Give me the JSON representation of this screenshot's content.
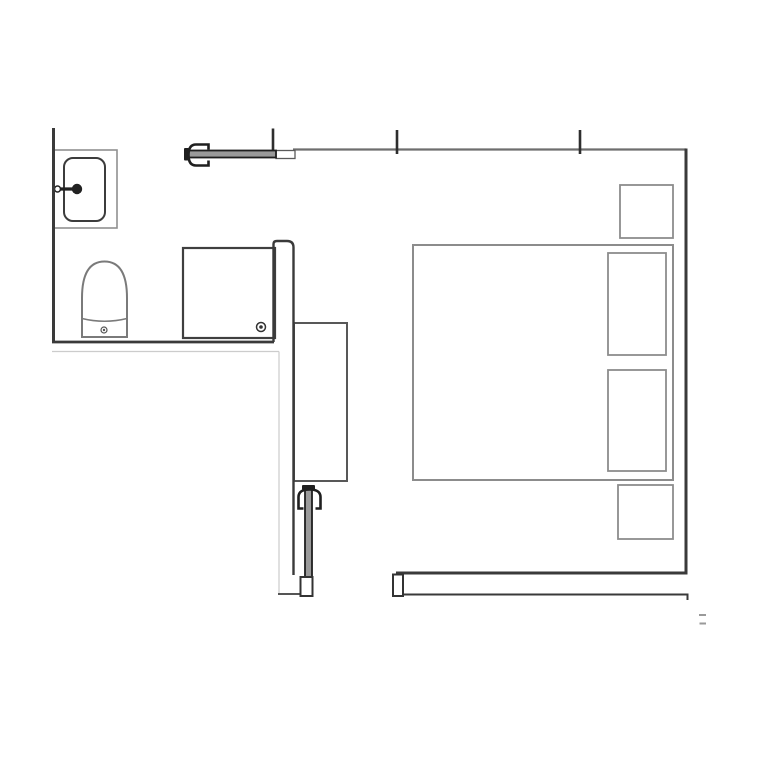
{
  "canvas": {
    "width": 768,
    "height": 768,
    "background": "#ffffff"
  },
  "palette": {
    "wall_dark": "#3a3a3a",
    "wall_medium": "#6e6e6e",
    "fixture_dark": "#3c3c3c",
    "fixture_gray": "#7a7a7a",
    "furniture_gray": "#8c8c8c",
    "door_dark": "#1f1f1f",
    "door_fill": "#9a9a9a",
    "faint_line": "#cccccc"
  },
  "floor_plan": {
    "rooms": [
      {
        "name": "bathroom"
      },
      {
        "name": "bedroom"
      }
    ],
    "shapes": [
      {
        "name": "bathroom-wall-shadow-line",
        "type": "line",
        "x1": 52,
        "y1": 351.5,
        "x2": 279,
        "y2": 351.5,
        "stroke": "#cccccc",
        "sw": 1.2
      },
      {
        "name": "hall-wall-faint-line",
        "type": "line",
        "x1": 279,
        "y1": 351.5,
        "x2": 279,
        "y2": 594,
        "stroke": "#cccccc",
        "sw": 1.2
      },
      {
        "name": "sink-counter",
        "type": "rect",
        "x": 53,
        "y": 150,
        "width": 64,
        "height": 78,
        "stroke": "#909090",
        "sw": 1.6,
        "fill": "#ffffff"
      },
      {
        "name": "sink-basin",
        "type": "rect",
        "x": 64,
        "y": 158,
        "width": 41,
        "height": 63,
        "rx": 9,
        "stroke": "#3c3c3c",
        "sw": 2,
        "fill": "#ffffff"
      },
      {
        "name": "sink-faucet-stem",
        "type": "line",
        "x1": 52,
        "y1": 189,
        "x2": 73,
        "y2": 189,
        "stroke": "#222222",
        "sw": 3.2
      },
      {
        "name": "sink-faucet-handle",
        "type": "circle",
        "cx": 77,
        "cy": 189,
        "r": 5.2,
        "fill": "#222222"
      },
      {
        "name": "sink-faucet-valve",
        "type": "circle",
        "cx": 57.5,
        "cy": 189,
        "r": 3,
        "stroke": "#222222",
        "sw": 1.5,
        "fill": "#ffffff"
      },
      {
        "name": "toilet-body",
        "type": "path",
        "d": "M82 337 L82 298 Q82 261.5 104.5 261.5 Q127 261.5 127 298 L127 337 Z",
        "stroke": "#7a7a7a",
        "sw": 2,
        "fill": "#ffffff"
      },
      {
        "name": "toilet-seat-line",
        "type": "path",
        "d": "M82 318.5 Q104.5 324 127 318.5",
        "stroke": "#7a7a7a",
        "sw": 1.6
      },
      {
        "name": "toilet-bolt",
        "type": "circle",
        "cx": 104,
        "cy": 330,
        "r": 3,
        "stroke": "#555555",
        "sw": 1.2,
        "fill": "#ffffff"
      },
      {
        "name": "toilet-bolt-dot",
        "type": "circle",
        "cx": 104,
        "cy": 330,
        "r": 1.2,
        "fill": "#555555"
      },
      {
        "name": "shower-tray",
        "type": "rect",
        "x": 183,
        "y": 248,
        "width": 92,
        "height": 90,
        "stroke": "#3f3f3f",
        "sw": 2.2,
        "fill": "#ffffff"
      },
      {
        "name": "shower-drain",
        "type": "circle",
        "cx": 261,
        "cy": 327,
        "r": 4.5,
        "stroke": "#333333",
        "sw": 1.5,
        "fill": "#ffffff"
      },
      {
        "name": "shower-drain-dot",
        "type": "circle",
        "cx": 261,
        "cy": 327,
        "r": 1.8,
        "fill": "#333333"
      },
      {
        "name": "wardrobe",
        "type": "rect",
        "x": 294,
        "y": 323,
        "width": 53,
        "height": 158,
        "stroke": "#585858",
        "sw": 2,
        "fill": "#ffffff"
      },
      {
        "name": "bed",
        "type": "rect",
        "x": 413,
        "y": 245,
        "width": 260,
        "height": 235,
        "stroke": "#8c8c8c",
        "sw": 2,
        "fill": "#ffffff"
      },
      {
        "name": "pillow-top",
        "type": "rect",
        "x": 608,
        "y": 253,
        "width": 58,
        "height": 102,
        "stroke": "#8c8c8c",
        "sw": 1.8,
        "fill": "#ffffff"
      },
      {
        "name": "pillow-bottom",
        "type": "rect",
        "x": 608,
        "y": 370,
        "width": 58,
        "height": 101,
        "stroke": "#8c8c8c",
        "sw": 1.8,
        "fill": "#ffffff"
      },
      {
        "name": "nightstand-top",
        "type": "rect",
        "x": 620,
        "y": 185,
        "width": 53,
        "height": 53,
        "stroke": "#8c8c8c",
        "sw": 1.8,
        "fill": "#ffffff"
      },
      {
        "name": "nightstand-bottom",
        "type": "rect",
        "x": 618,
        "y": 485,
        "width": 55,
        "height": 54,
        "stroke": "#8c8c8c",
        "sw": 1.8,
        "fill": "#ffffff"
      },
      {
        "name": "partition-wall",
        "type": "path",
        "d": "M273.5 342 L273.5 244 Q273.5 241 277 241 L287 241 Q293.5 241 293.5 247.5 L293.5 575",
        "stroke": "#3a3a3a",
        "sw": 2.4
      },
      {
        "name": "left-wall",
        "type": "line",
        "x1": 53.5,
        "y1": 128,
        "x2": 53.5,
        "y2": 343,
        "stroke": "#3a3a3a",
        "sw": 3
      },
      {
        "name": "bathroom-bottom-wall",
        "type": "line",
        "x1": 52,
        "y1": 342,
        "x2": 274,
        "y2": 342,
        "stroke": "#3a3a3a",
        "sw": 2.8
      },
      {
        "name": "top-wall",
        "type": "line",
        "x1": 293,
        "y1": 149.5,
        "x2": 686,
        "y2": 149.5,
        "stroke": "#6e6e6e",
        "sw": 2.2
      },
      {
        "name": "top-door-frame-jog",
        "type": "rect",
        "x": 276,
        "y": 150.5,
        "width": 19,
        "height": 8,
        "stroke": "#5a5a5a",
        "sw": 1.3,
        "fill": "#ffffff"
      },
      {
        "name": "wall-tick-left",
        "type": "line",
        "x1": 273,
        "y1": 128.5,
        "x2": 273,
        "y2": 155,
        "stroke": "#2e2e2e",
        "sw": 2.6
      },
      {
        "name": "wall-tick-mid",
        "type": "line",
        "x1": 397,
        "y1": 130,
        "x2": 397,
        "y2": 154,
        "stroke": "#2e2e2e",
        "sw": 2.6
      },
      {
        "name": "wall-tick-right",
        "type": "line",
        "x1": 580,
        "y1": 130,
        "x2": 580,
        "y2": 154,
        "stroke": "#2e2e2e",
        "sw": 2.6
      },
      {
        "name": "right-wall",
        "type": "line",
        "x1": 686,
        "y1": 148.5,
        "x2": 686,
        "y2": 574.5,
        "stroke": "#3a3a3a",
        "sw": 3
      },
      {
        "name": "bottom-wall",
        "type": "line",
        "x1": 396,
        "y1": 573,
        "x2": 687.5,
        "y2": 573,
        "stroke": "#3a3a3a",
        "sw": 3
      },
      {
        "name": "bottom-rail",
        "type": "path",
        "d": "M397 594.5 L687.5 594.5 L687.5 600",
        "stroke": "#3a3a3a",
        "sw": 2
      },
      {
        "name": "bottom-rail-end-cap",
        "type": "rect",
        "x": 393,
        "y": 574.5,
        "width": 10,
        "height": 21.5,
        "stroke": "#333333",
        "sw": 2,
        "fill": "#ffffff"
      },
      {
        "name": "entry-wall-stub",
        "type": "line",
        "x1": 278,
        "y1": 594,
        "x2": 301,
        "y2": 594,
        "stroke": "#555555",
        "sw": 2
      },
      {
        "name": "entry-door-leaf",
        "type": "rect",
        "x": 305,
        "y": 489,
        "width": 7,
        "height": 88,
        "stroke": "#1f1f1f",
        "sw": 1.8,
        "fill": "#9a9a9a"
      },
      {
        "name": "entry-door-pivot",
        "type": "rect",
        "x": 302,
        "y": 485,
        "width": 13,
        "height": 5,
        "rx": 1,
        "fill": "#1f1f1f"
      },
      {
        "name": "entry-door-hinge",
        "type": "path",
        "d": "M303.5 508.5 L298.5 508.5 L298.5 497 Q298.5 489.5 309.5 489.5 Q320.5 489.5 320.5 497 L320.5 508.5 L315.5 508.5",
        "stroke": "#1f1f1f",
        "sw": 2.6
      },
      {
        "name": "entry-door-frame",
        "type": "rect",
        "x": 300.5,
        "y": 577,
        "width": 12,
        "height": 19,
        "stroke": "#333333",
        "sw": 2,
        "fill": "#ffffff"
      },
      {
        "name": "bathroom-door-leaf",
        "type": "rect",
        "x": 187,
        "y": 150.5,
        "width": 89,
        "height": 7,
        "stroke": "#1f1f1f",
        "sw": 1.8,
        "fill": "#9a9a9a"
      },
      {
        "name": "bathroom-door-pivot",
        "type": "rect",
        "x": 184,
        "y": 148,
        "width": 5,
        "height": 12.5,
        "rx": 1,
        "fill": "#1f1f1f"
      },
      {
        "name": "bathroom-door-hinge",
        "type": "path",
        "d": "M208.5 149.5 L208.5 144.5 L196 144.5 Q188.5 144.5 188.5 155 Q188.5 165.5 196 165.5 L208.5 165.5 L208.5 160.5",
        "stroke": "#1f1f1f",
        "sw": 2.6
      },
      {
        "name": "stray-mark-top",
        "type": "rect",
        "x": 699,
        "y": 614,
        "width": 7,
        "height": 2,
        "fill": "#9a9a9a"
      },
      {
        "name": "stray-mark-bottom",
        "type": "rect",
        "x": 699.5,
        "y": 622.5,
        "width": 6.5,
        "height": 2,
        "fill": "#9a9a9a"
      }
    ]
  }
}
